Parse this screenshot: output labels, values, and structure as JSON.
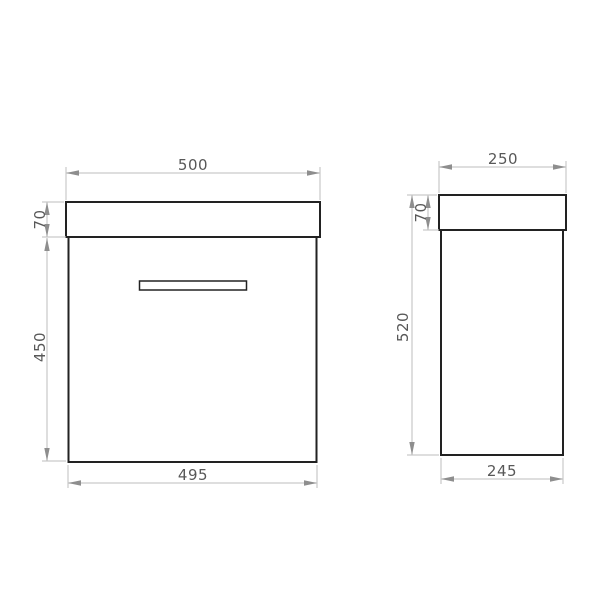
{
  "colors": {
    "paper": "#ffffff",
    "object-line": "#222222",
    "dim-line": "#c9c9c9",
    "arrow": "#8e8e8e",
    "dim-text": "#585858"
  },
  "drawing": {
    "front_view": {
      "dims": {
        "top_width": "500",
        "worktop_height": "70",
        "cabinet_height": "450",
        "cabinet_width": "495"
      }
    },
    "side_view": {
      "dims": {
        "top_depth": "250",
        "worktop_height": "70",
        "overall_height": "520",
        "cabinet_depth": "245"
      }
    }
  }
}
